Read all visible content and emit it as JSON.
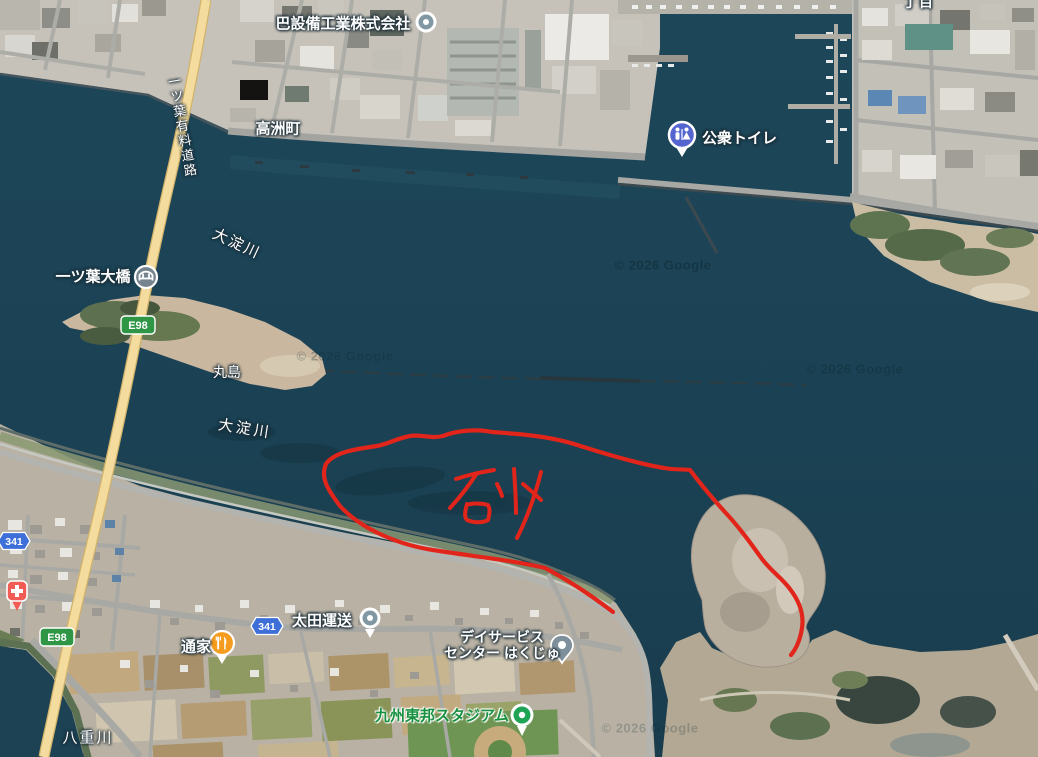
{
  "map": {
    "attribution": "© 2026 Google",
    "labels": {
      "company": "巴設備工業株式会社",
      "public_toilet": "公衆トイレ",
      "town": "高洲町",
      "toll_road": "一ツ葉有料道路",
      "river_upper": "大淀川",
      "river_mid": "大淀川",
      "bridge": "一ツ葉大橋",
      "island": "丸島",
      "district_partial": "丁目",
      "transport_co": "太田運送",
      "restaurant": "通家",
      "daycare_line1": "デイサービス",
      "daycare_line2": "センター はくじゅ",
      "stadium": "九州東邦スタジアム",
      "river_bottom": "八重川"
    },
    "route_shields": {
      "expressway": "E98",
      "national": "341"
    },
    "annotation": {
      "text": "砂",
      "color": "#e1251b"
    },
    "colors": {
      "water": "#1c4356",
      "sand": "#c9b7a0",
      "road_yellow": "#f3dc9e",
      "annotation_red": "#e1251b"
    }
  }
}
